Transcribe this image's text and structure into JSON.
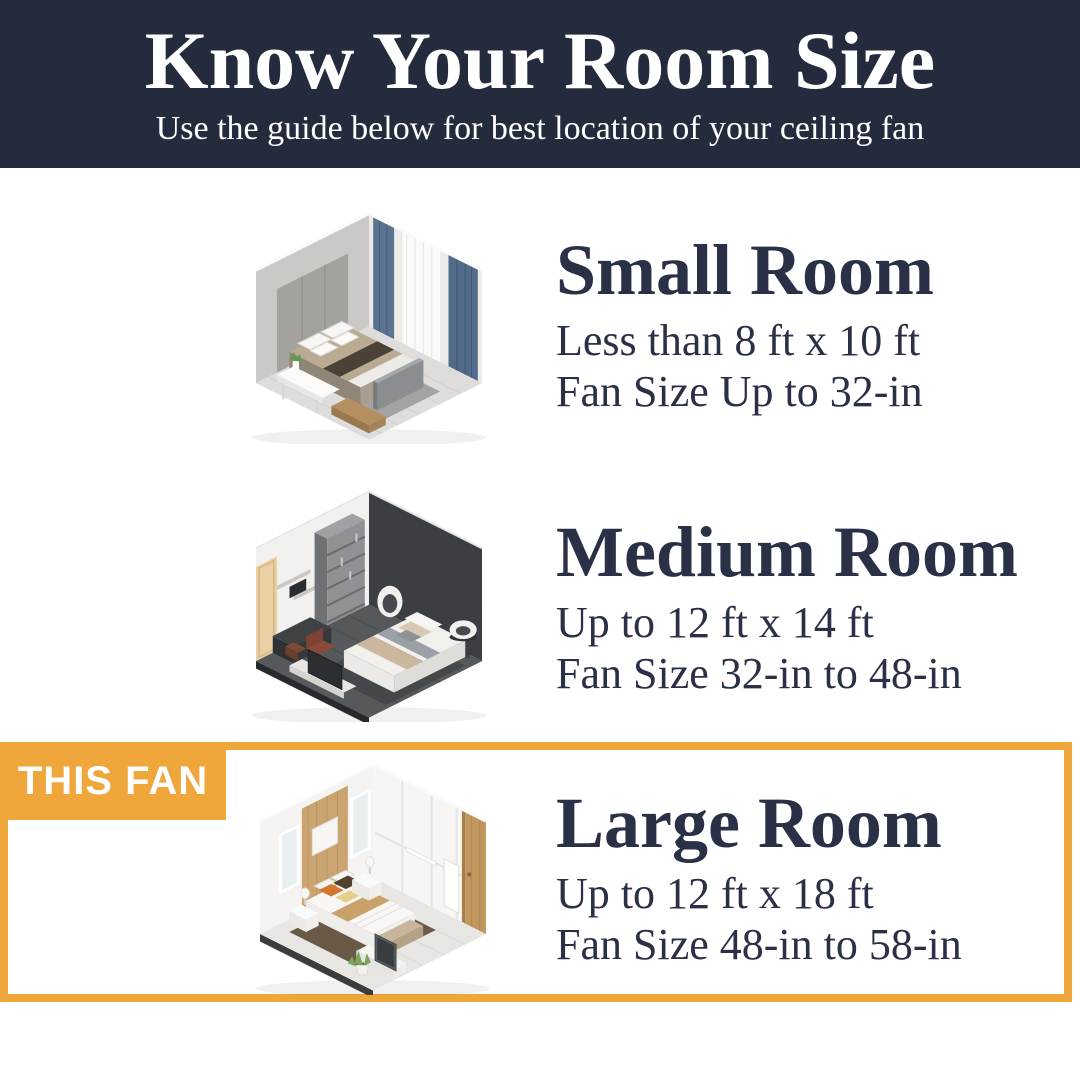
{
  "header": {
    "title": "Know Your Room Size",
    "subtitle": "Use the guide below for best location of your ceiling fan"
  },
  "this_fan_badge": "THIS FAN",
  "rooms": [
    {
      "name": "Small Room",
      "size_range": "Less than 8 ft x 10 ft",
      "fan_size": "Fan Size Up to 32-in",
      "highlighted": false
    },
    {
      "name": "Medium Room",
      "size_range": "Up to 12 ft x 14 ft",
      "fan_size": "Fan Size 32-in to 48-in",
      "highlighted": false
    },
    {
      "name": "Large Room",
      "size_range": "Up to 12 ft x 18 ft",
      "fan_size": "Fan Size 48-in to 58-in",
      "highlighted": true
    }
  ],
  "colors": {
    "header_bg": "#242B3D",
    "ink": "#2A3146",
    "accent_orange": "#EFA63B",
    "badge_text": "#FFFFFF",
    "background": "#FFFFFF"
  }
}
